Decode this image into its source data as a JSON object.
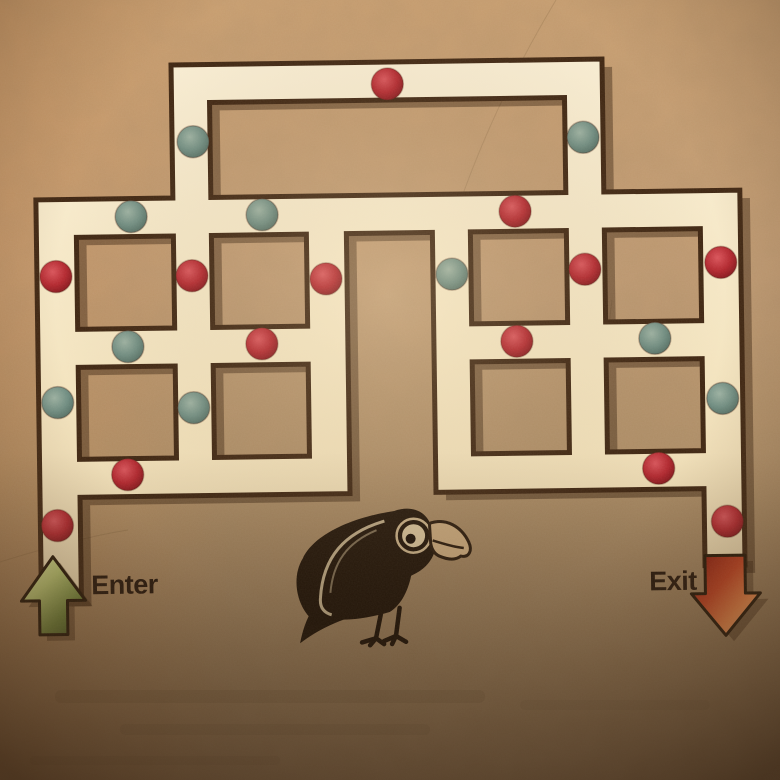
{
  "puzzle": {
    "enter_label": "Enter",
    "exit_label": "Exit"
  },
  "icons": {
    "enter_arrow": "up-arrow-icon",
    "exit_arrow": "down-arrow-icon",
    "crow": "crow-illustration",
    "red_gem": "red-berry-gem-icon",
    "green_gem": "green-berry-gem-icon"
  },
  "colors": {
    "paper": "#b99672",
    "path": "#f4e6c4",
    "wall": "#3d2410",
    "gem_red": "#b5282f",
    "gem_green": "#6f8d82",
    "enter_arrow": "#9fb157",
    "exit_arrow": "#d9571f",
    "label_text": "#26160a"
  },
  "gems": [
    {
      "x": 391,
      "y": 84,
      "color": "red"
    },
    {
      "x": 196,
      "y": 139,
      "color": "green"
    },
    {
      "x": 586,
      "y": 140,
      "color": "green"
    },
    {
      "x": 133,
      "y": 213,
      "color": "green"
    },
    {
      "x": 264,
      "y": 213,
      "color": "green"
    },
    {
      "x": 517,
      "y": 213,
      "color": "red"
    },
    {
      "x": 57,
      "y": 272,
      "color": "red"
    },
    {
      "x": 193,
      "y": 273,
      "color": "red"
    },
    {
      "x": 327,
      "y": 278,
      "color": "red"
    },
    {
      "x": 453,
      "y": 275,
      "color": "green"
    },
    {
      "x": 586,
      "y": 272,
      "color": "red"
    },
    {
      "x": 722,
      "y": 267,
      "color": "red"
    },
    {
      "x": 128,
      "y": 343,
      "color": "green"
    },
    {
      "x": 262,
      "y": 342,
      "color": "red"
    },
    {
      "x": 517,
      "y": 343,
      "color": "red"
    },
    {
      "x": 655,
      "y": 342,
      "color": "green"
    },
    {
      "x": 57,
      "y": 398,
      "color": "green"
    },
    {
      "x": 193,
      "y": 405,
      "color": "green"
    },
    {
      "x": 722,
      "y": 403,
      "color": "green"
    },
    {
      "x": 126,
      "y": 471,
      "color": "red"
    },
    {
      "x": 657,
      "y": 472,
      "color": "red"
    },
    {
      "x": 55,
      "y": 521,
      "color": "red"
    },
    {
      "x": 725,
      "y": 526,
      "color": "red"
    }
  ]
}
